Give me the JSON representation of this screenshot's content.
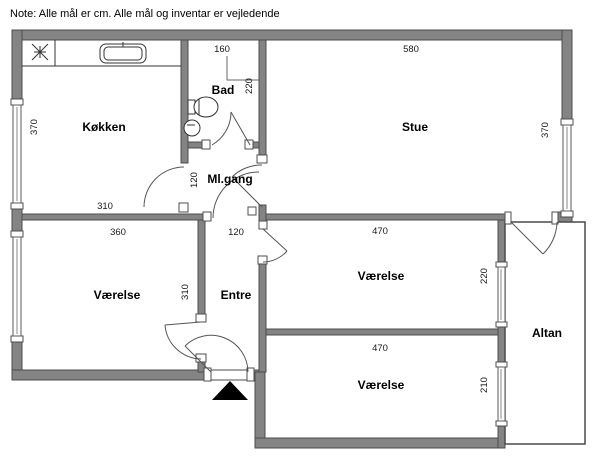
{
  "note": "Note: Alle mål er cm. Alle mål og inventar er vejledende",
  "rooms": {
    "kitchen": {
      "label": "Køkken"
    },
    "bath": {
      "label": "Bad"
    },
    "living": {
      "label": "Stue"
    },
    "hallway": {
      "label": "Ml.gang"
    },
    "bedroom_left": {
      "label": "Værelse"
    },
    "entry": {
      "label": "Entre"
    },
    "bedroom_top": {
      "label": "Værelse"
    },
    "bedroom_bottom": {
      "label": "Værelse"
    },
    "balcony": {
      "label": "Altan"
    }
  },
  "dims": {
    "living_w": "580",
    "living_h": "370",
    "kitchen_h": "370",
    "kitchen_w": "310",
    "bath_w": "160",
    "bath_h": "220",
    "hall_h": "120",
    "bedroom_left_w": "360",
    "bedroom_left_h": "310",
    "entry_w": "120",
    "bedroom_top_w": "470",
    "bedroom_top_h": "220",
    "bedroom_bottom_w": "470",
    "bedroom_bottom_h": "210"
  },
  "colors": {
    "wall": "#848484",
    "wall_edge": "#4d4d4d",
    "line": "#333333",
    "entrance_marker": "#000000",
    "background": "#ffffff"
  },
  "icons": {
    "entrance_arrow": "filled triangle pointing up at entrance door",
    "stove": "4-point burner star in kitchen corner",
    "kitchen_sink": "rounded rectangle sink on counter",
    "toilet": "oval toilet with cistern against bath wall",
    "basin": "round wash basin in bath"
  }
}
